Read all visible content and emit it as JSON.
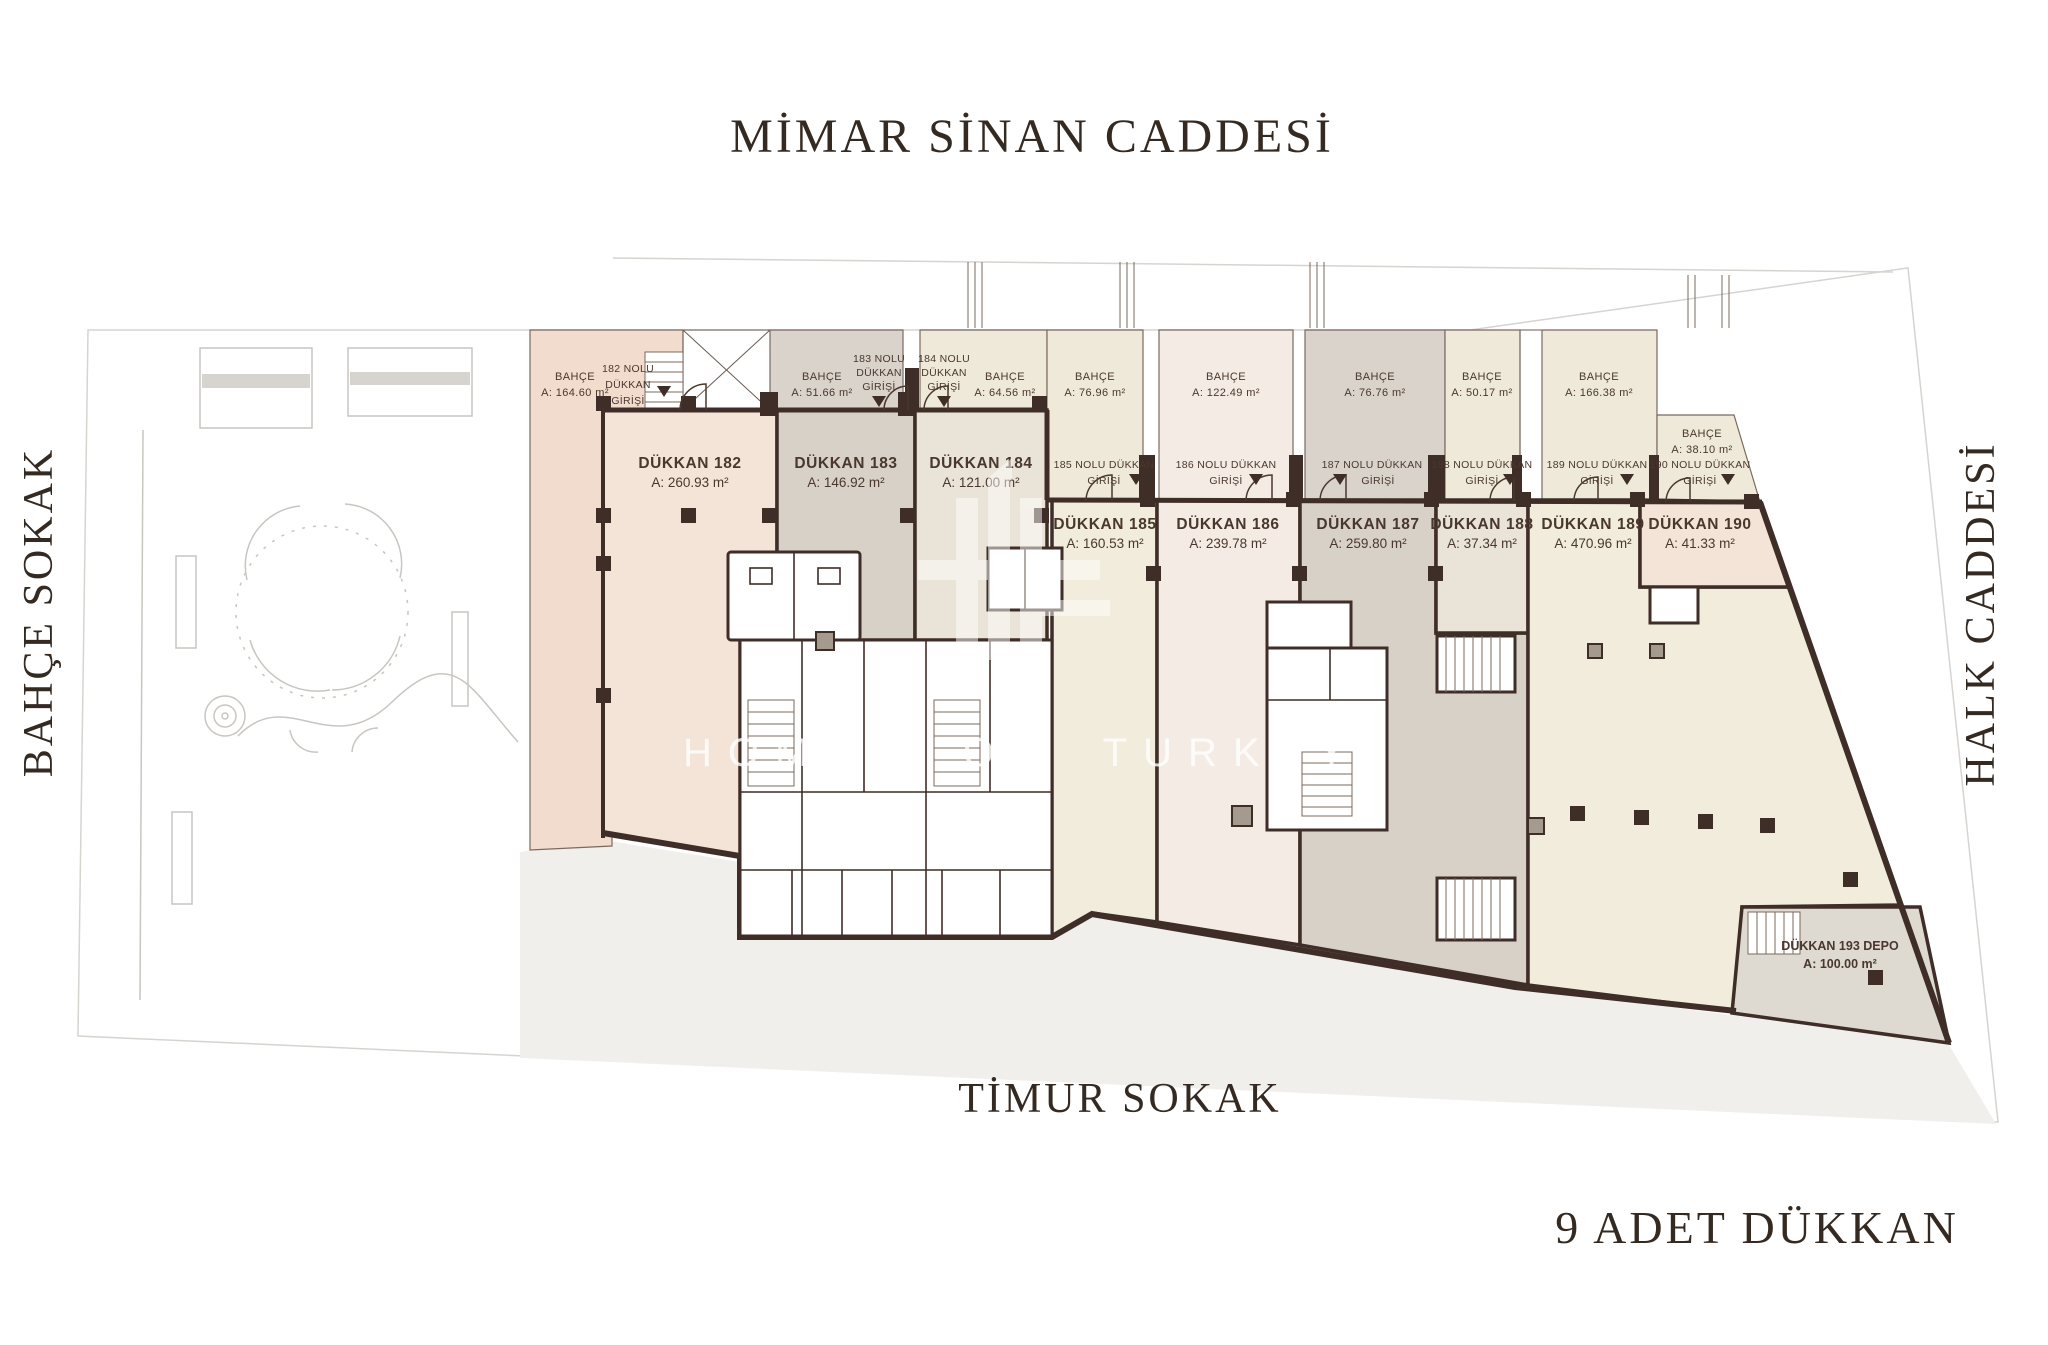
{
  "streets": {
    "top": "MİMAR SİNAN CADDESİ",
    "left": "BAHÇE SOKAK",
    "right": "HALK CADDESİ",
    "bottom": "TİMUR SOKAK"
  },
  "caption": "9 ADET DÜKKAN",
  "watermark": "HOMES OF TURKEY",
  "colors": {
    "wall": "#3f2d27",
    "peach": "#f4e4d8",
    "peach_garden": "#f2dccd",
    "gray": "#d8d1c8",
    "gray_garden": "#d9d3cb",
    "cream": "#f1ecdc",
    "cream_garden": "#efe9da",
    "blush": "#f4ece4",
    "beige": "#e9e4d7",
    "depo": "#dedad2",
    "white": "#ffffff",
    "site": "#f1efec"
  },
  "shops": [
    {
      "name": "DÜKKAN 182",
      "area": "A: 260.93 m²"
    },
    {
      "name": "DÜKKAN 183",
      "area": "A: 146.92 m²"
    },
    {
      "name": "DÜKKAN 184",
      "area": "A: 121.00 m²"
    },
    {
      "name": "DÜKKAN 185",
      "area": "A: 160.53 m²"
    },
    {
      "name": "DÜKKAN 186",
      "area": "A: 239.78 m²"
    },
    {
      "name": "DÜKKAN 187",
      "area": "A: 259.80 m²"
    },
    {
      "name": "DÜKKAN 188",
      "area": "A: 37.34 m²"
    },
    {
      "name": "DÜKKAN 189",
      "area": "A: 470.96 m²"
    },
    {
      "name": "DÜKKAN 190",
      "area": "A: 41.33 m²"
    },
    {
      "name": "DÜKKAN 193 DEPO",
      "area": "A: 100.00 m²"
    }
  ],
  "gardens": [
    {
      "name": "BAHÇE",
      "area": "A: 164.60 m²"
    },
    {
      "name": "BAHÇE",
      "area": "A: 51.66 m²"
    },
    {
      "name": "BAHÇE",
      "area": "A: 64.56 m²"
    },
    {
      "name": "BAHÇE",
      "area": "A: 76.96 m²"
    },
    {
      "name": "BAHÇE",
      "area": "A: 122.49 m²"
    },
    {
      "name": "BAHÇE",
      "area": "A: 76.76 m²"
    },
    {
      "name": "BAHÇE",
      "area": "A: 50.17 m²"
    },
    {
      "name": "BAHÇE",
      "area": "A: 166.38 m²"
    },
    {
      "name": "BAHÇE",
      "area": "A: 38.10 m²"
    }
  ],
  "entrances": [
    {
      "lines": [
        "182 NOLU",
        "DÜKKAN",
        "GİRİŞİ"
      ]
    },
    {
      "lines": [
        "183 NOLU",
        "DÜKKAN",
        "GİRİŞİ"
      ]
    },
    {
      "lines": [
        "184 NOLU",
        "DÜKKAN",
        "GİRİŞİ"
      ]
    },
    {
      "lines": [
        "185 NOLU DÜKKAN",
        "GİRİŞİ"
      ]
    },
    {
      "lines": [
        "186 NOLU DÜKKAN",
        "GİRİŞİ"
      ]
    },
    {
      "lines": [
        "187 NOLU DÜKKAN",
        "GİRİŞİ"
      ]
    },
    {
      "lines": [
        "188 NOLU DÜKKAN",
        "GİRİŞİ"
      ]
    },
    {
      "lines": [
        "189 NOLU DÜKKAN",
        "GİRİŞİ"
      ]
    },
    {
      "lines": [
        "190 NOLU DÜKKAN",
        "GİRİŞİ"
      ]
    }
  ]
}
